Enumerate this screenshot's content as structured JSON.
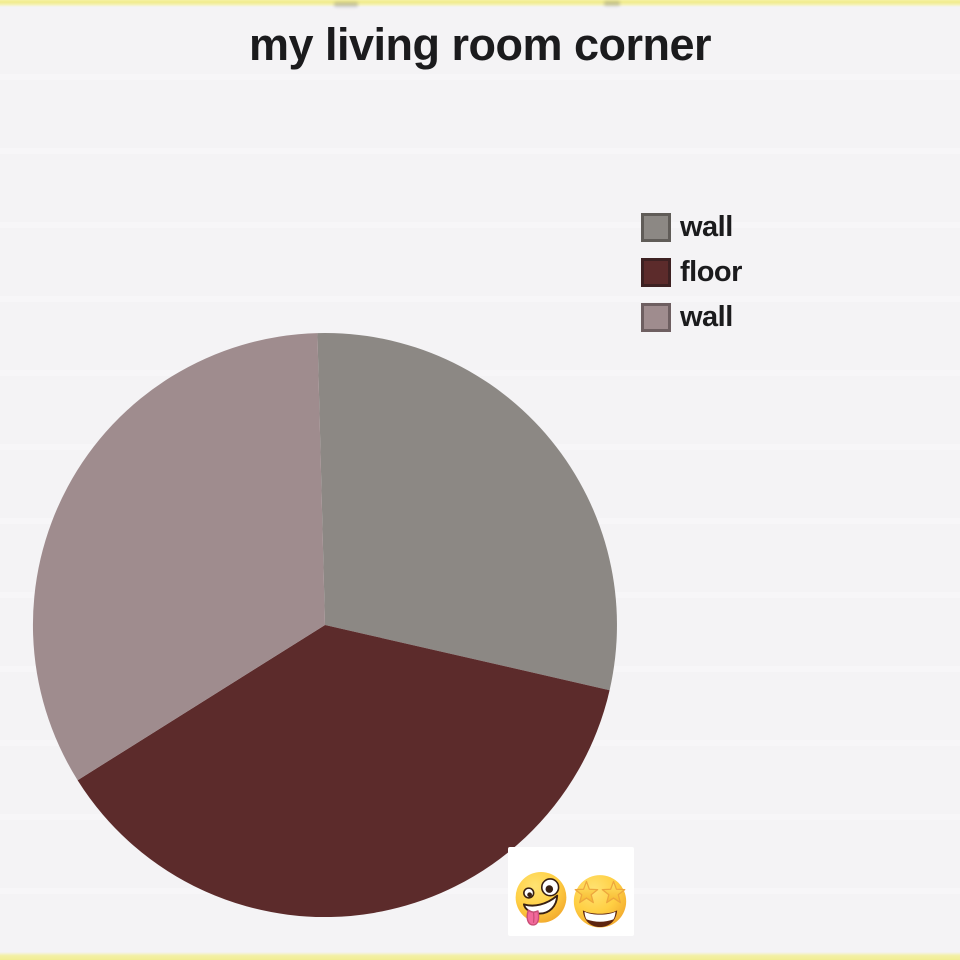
{
  "page": {
    "background_color": "#f4f3f5",
    "top_border_color": "#f0eb8d",
    "bottom_border_color": "#f1ed92"
  },
  "chart_data": {
    "type": "pie",
    "title": "my living room corner",
    "slices": [
      {
        "label": "wall",
        "value": 29,
        "color": "#8c8884",
        "swatch_border": "#605c58"
      },
      {
        "label": "floor",
        "value": 37.5,
        "color": "#5c2b2b",
        "swatch_border": "#3d2122"
      },
      {
        "label": "wall",
        "value": 33.5,
        "color": "#9f8c8e",
        "swatch_border": "#6e5f61"
      }
    ],
    "values_unit": "percent (estimated from slice angles)",
    "start_angle_deg": -1.5,
    "direction": "clockwise",
    "legend_position": "right",
    "grid": false,
    "axes": false
  },
  "footer": {
    "emojis": [
      {
        "name": "zany-face",
        "char": "🤪"
      },
      {
        "name": "star-struck",
        "char": "🤩"
      }
    ]
  }
}
